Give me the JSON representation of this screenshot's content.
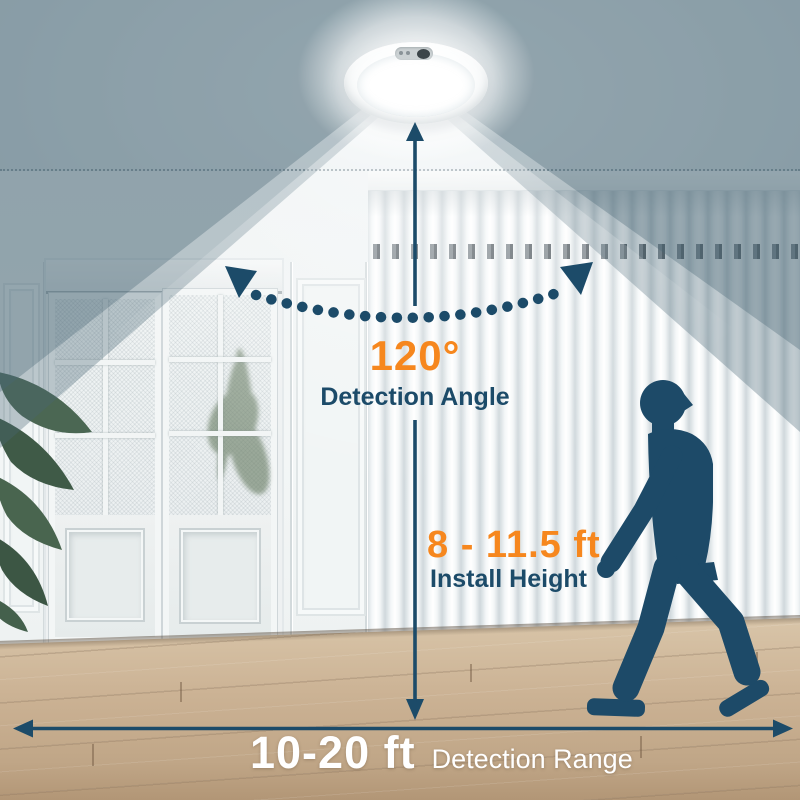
{
  "annotations": {
    "detection_angle": {
      "value": "120°",
      "label": "Detection Angle"
    },
    "install_height": {
      "value": "8 - 11.5 ft",
      "label": "Install Height"
    },
    "detection_range": {
      "value": "10-20 ft",
      "label": "Detection Range"
    }
  },
  "colors": {
    "accent": "#F6871E",
    "navy": "#1C4B69",
    "range_text": "#FFFFFF"
  },
  "graphics": {
    "subject": "motion-sensor-ceiling-light",
    "figure": "walking-person-silhouette"
  }
}
